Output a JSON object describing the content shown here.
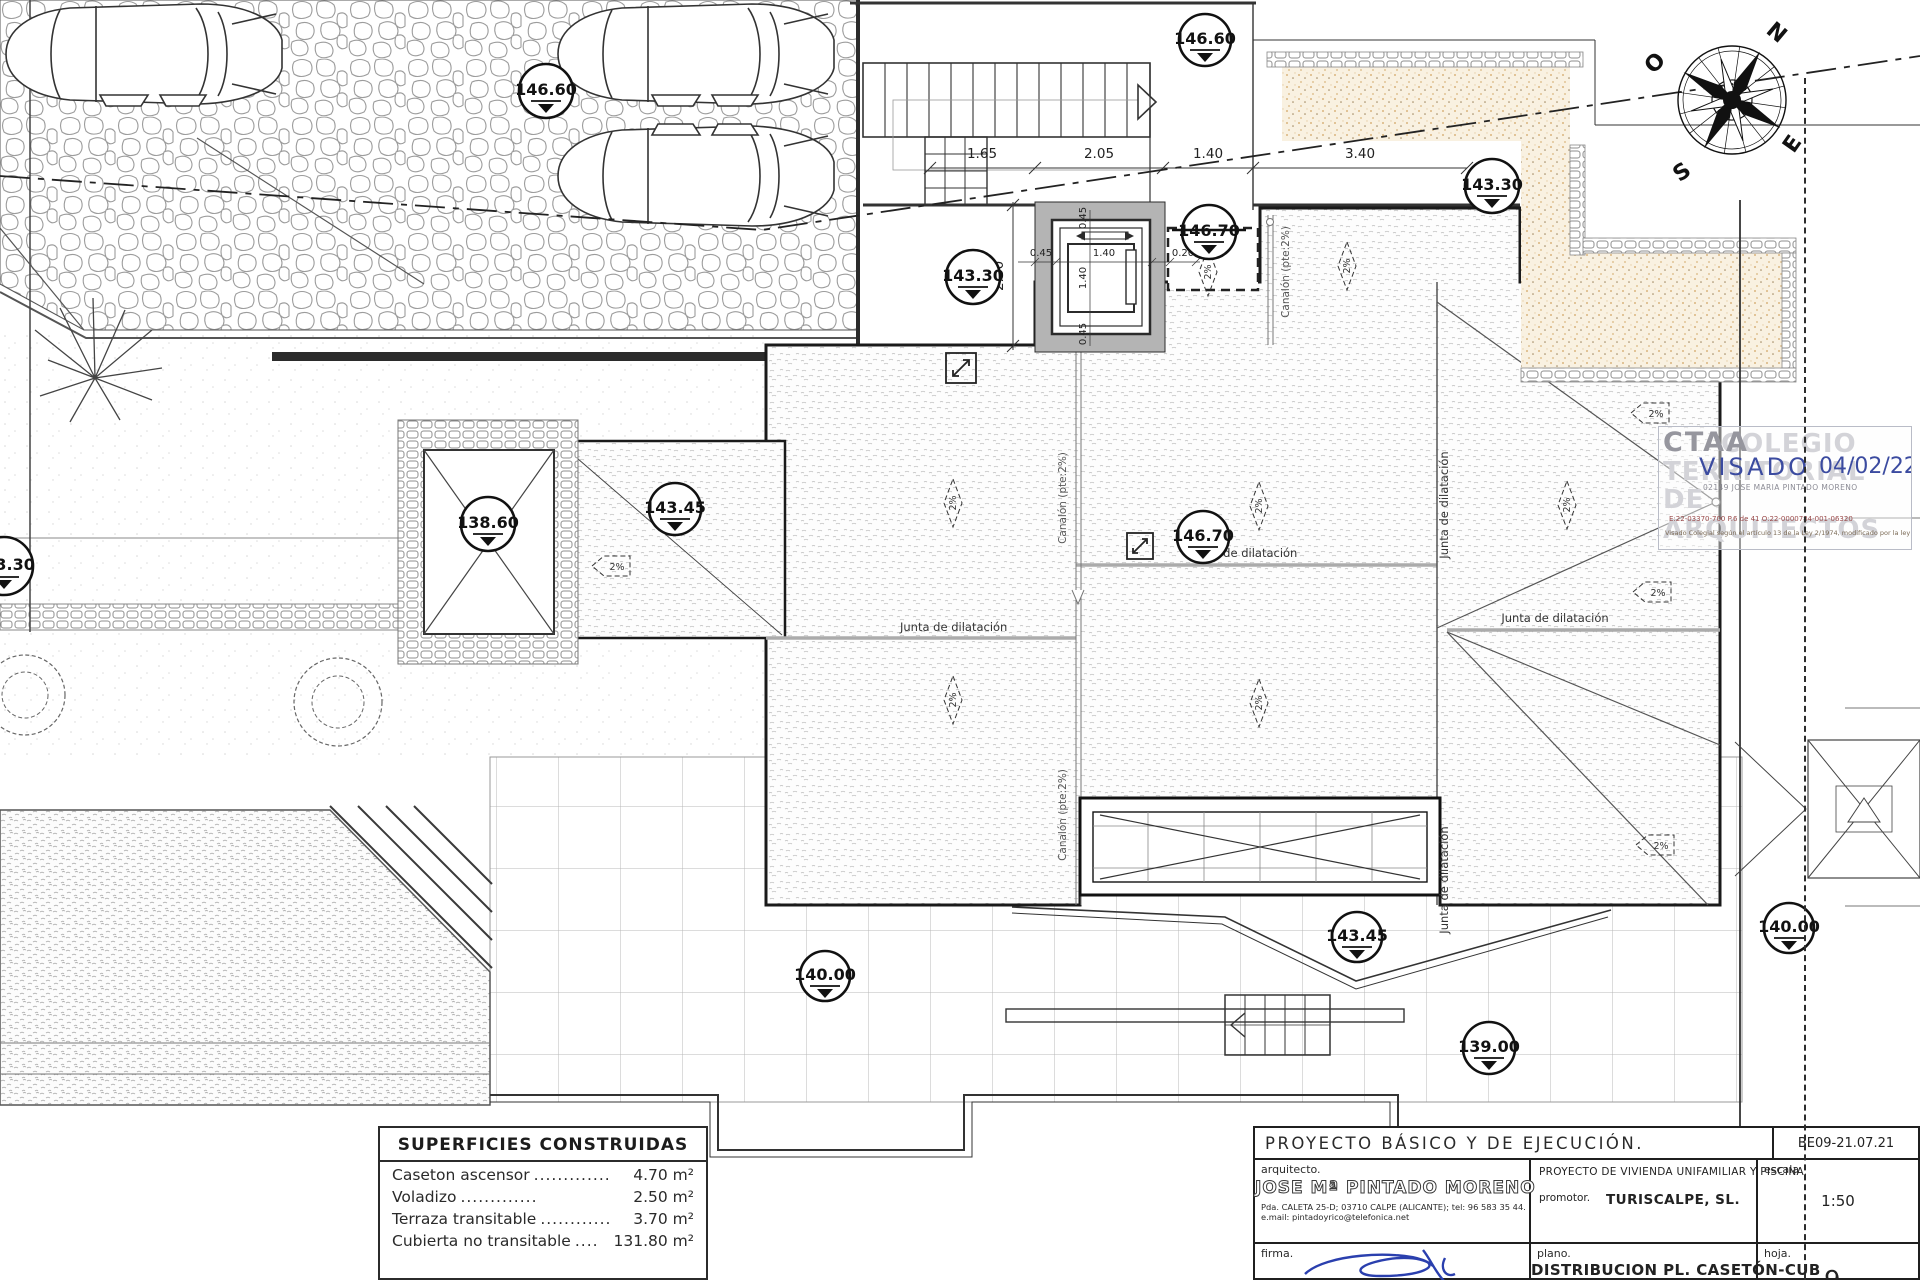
{
  "plan": {
    "levels": {
      "m1": "146.60",
      "m2": "146.60",
      "m3": "143.30",
      "m4": "146.70",
      "m5": "143.30",
      "m6": "143.30",
      "m7": "138.60",
      "m8": "143.45",
      "m9": "146.70",
      "m10": "143.45",
      "m11": "139.00",
      "m12": "140.00",
      "m13": "140.00"
    },
    "dims": {
      "d1": "1.65",
      "d2": "2.05",
      "d3": "1.40",
      "d4": "3.40",
      "v1": "2.30",
      "e1": "0.45",
      "e2": "1.40",
      "e3": "0.20",
      "ev1": "0.45",
      "ev2": "1.40",
      "ev3": "0.45"
    },
    "labels": {
      "junta": "Junta de dilatación",
      "canalon": "Canalón (pte:2%)",
      "slope": "2%"
    },
    "compass": {
      "n": "N",
      "e": "E",
      "s": "S",
      "o": "O"
    }
  },
  "areas_table": {
    "title": "SUPERFICIES CONSTRUIDAS",
    "rows": [
      {
        "label": "Caseton ascensor",
        "leader": ".............",
        "value": "4.70 m²"
      },
      {
        "label": "Voladizo",
        "leader": ".............",
        "value": "2.50 m²"
      },
      {
        "label": "Terraza transitable",
        "leader": "............",
        "value": "3.70 m²"
      },
      {
        "label": "Cubierta no transitable",
        "leader": "....",
        "value": "131.80 m²"
      }
    ]
  },
  "title_block": {
    "project": "PROYECTO BÁSICO Y DE EJECUCIÓN.",
    "code": "BE09-21.07.21",
    "architect_label": "arquitecto.",
    "architect": "JOSE Mª PINTADO MORENO",
    "address": "Pda. CALETA 25-D; 03710 CALPE (ALICANTE); tel: 96 583 35 44.",
    "email": "e.mail: pintadoyrico@telefonica.net",
    "project_type": "PROYECTO DE VIVIENDA UNIFAMILIAR Y PISCINA.",
    "promoter_label": "promotor.",
    "promoter": "TURISCALPE, SL.",
    "scale_label": "escala",
    "scale": "1:50",
    "signature_label": "firma.",
    "plan_label": "plano.",
    "plan_name": "DISTRIBUCION PL. CASETÓN-CUB",
    "sheet_label": "hoja.",
    "sheet_number": "9"
  },
  "stamp": {
    "org": "CTAA",
    "watermark_1": "COLEGIO",
    "watermark_2": "TERRITORIAL",
    "watermark_3": "DE ARQUITECTOS",
    "visado": "VISADO",
    "date": "04/02/22",
    "colegiado": "02149 JOSE MARIA PINTADO MORENO",
    "refs": "E:22-03370-700      P.6 de 41      O:22-0000784-001-06320",
    "legal": "Visado Colegial según el artículo 13 de la Ley 2/1974, modificado por la ley 25/2009",
    "accent_blue": "#3b4ba0"
  }
}
